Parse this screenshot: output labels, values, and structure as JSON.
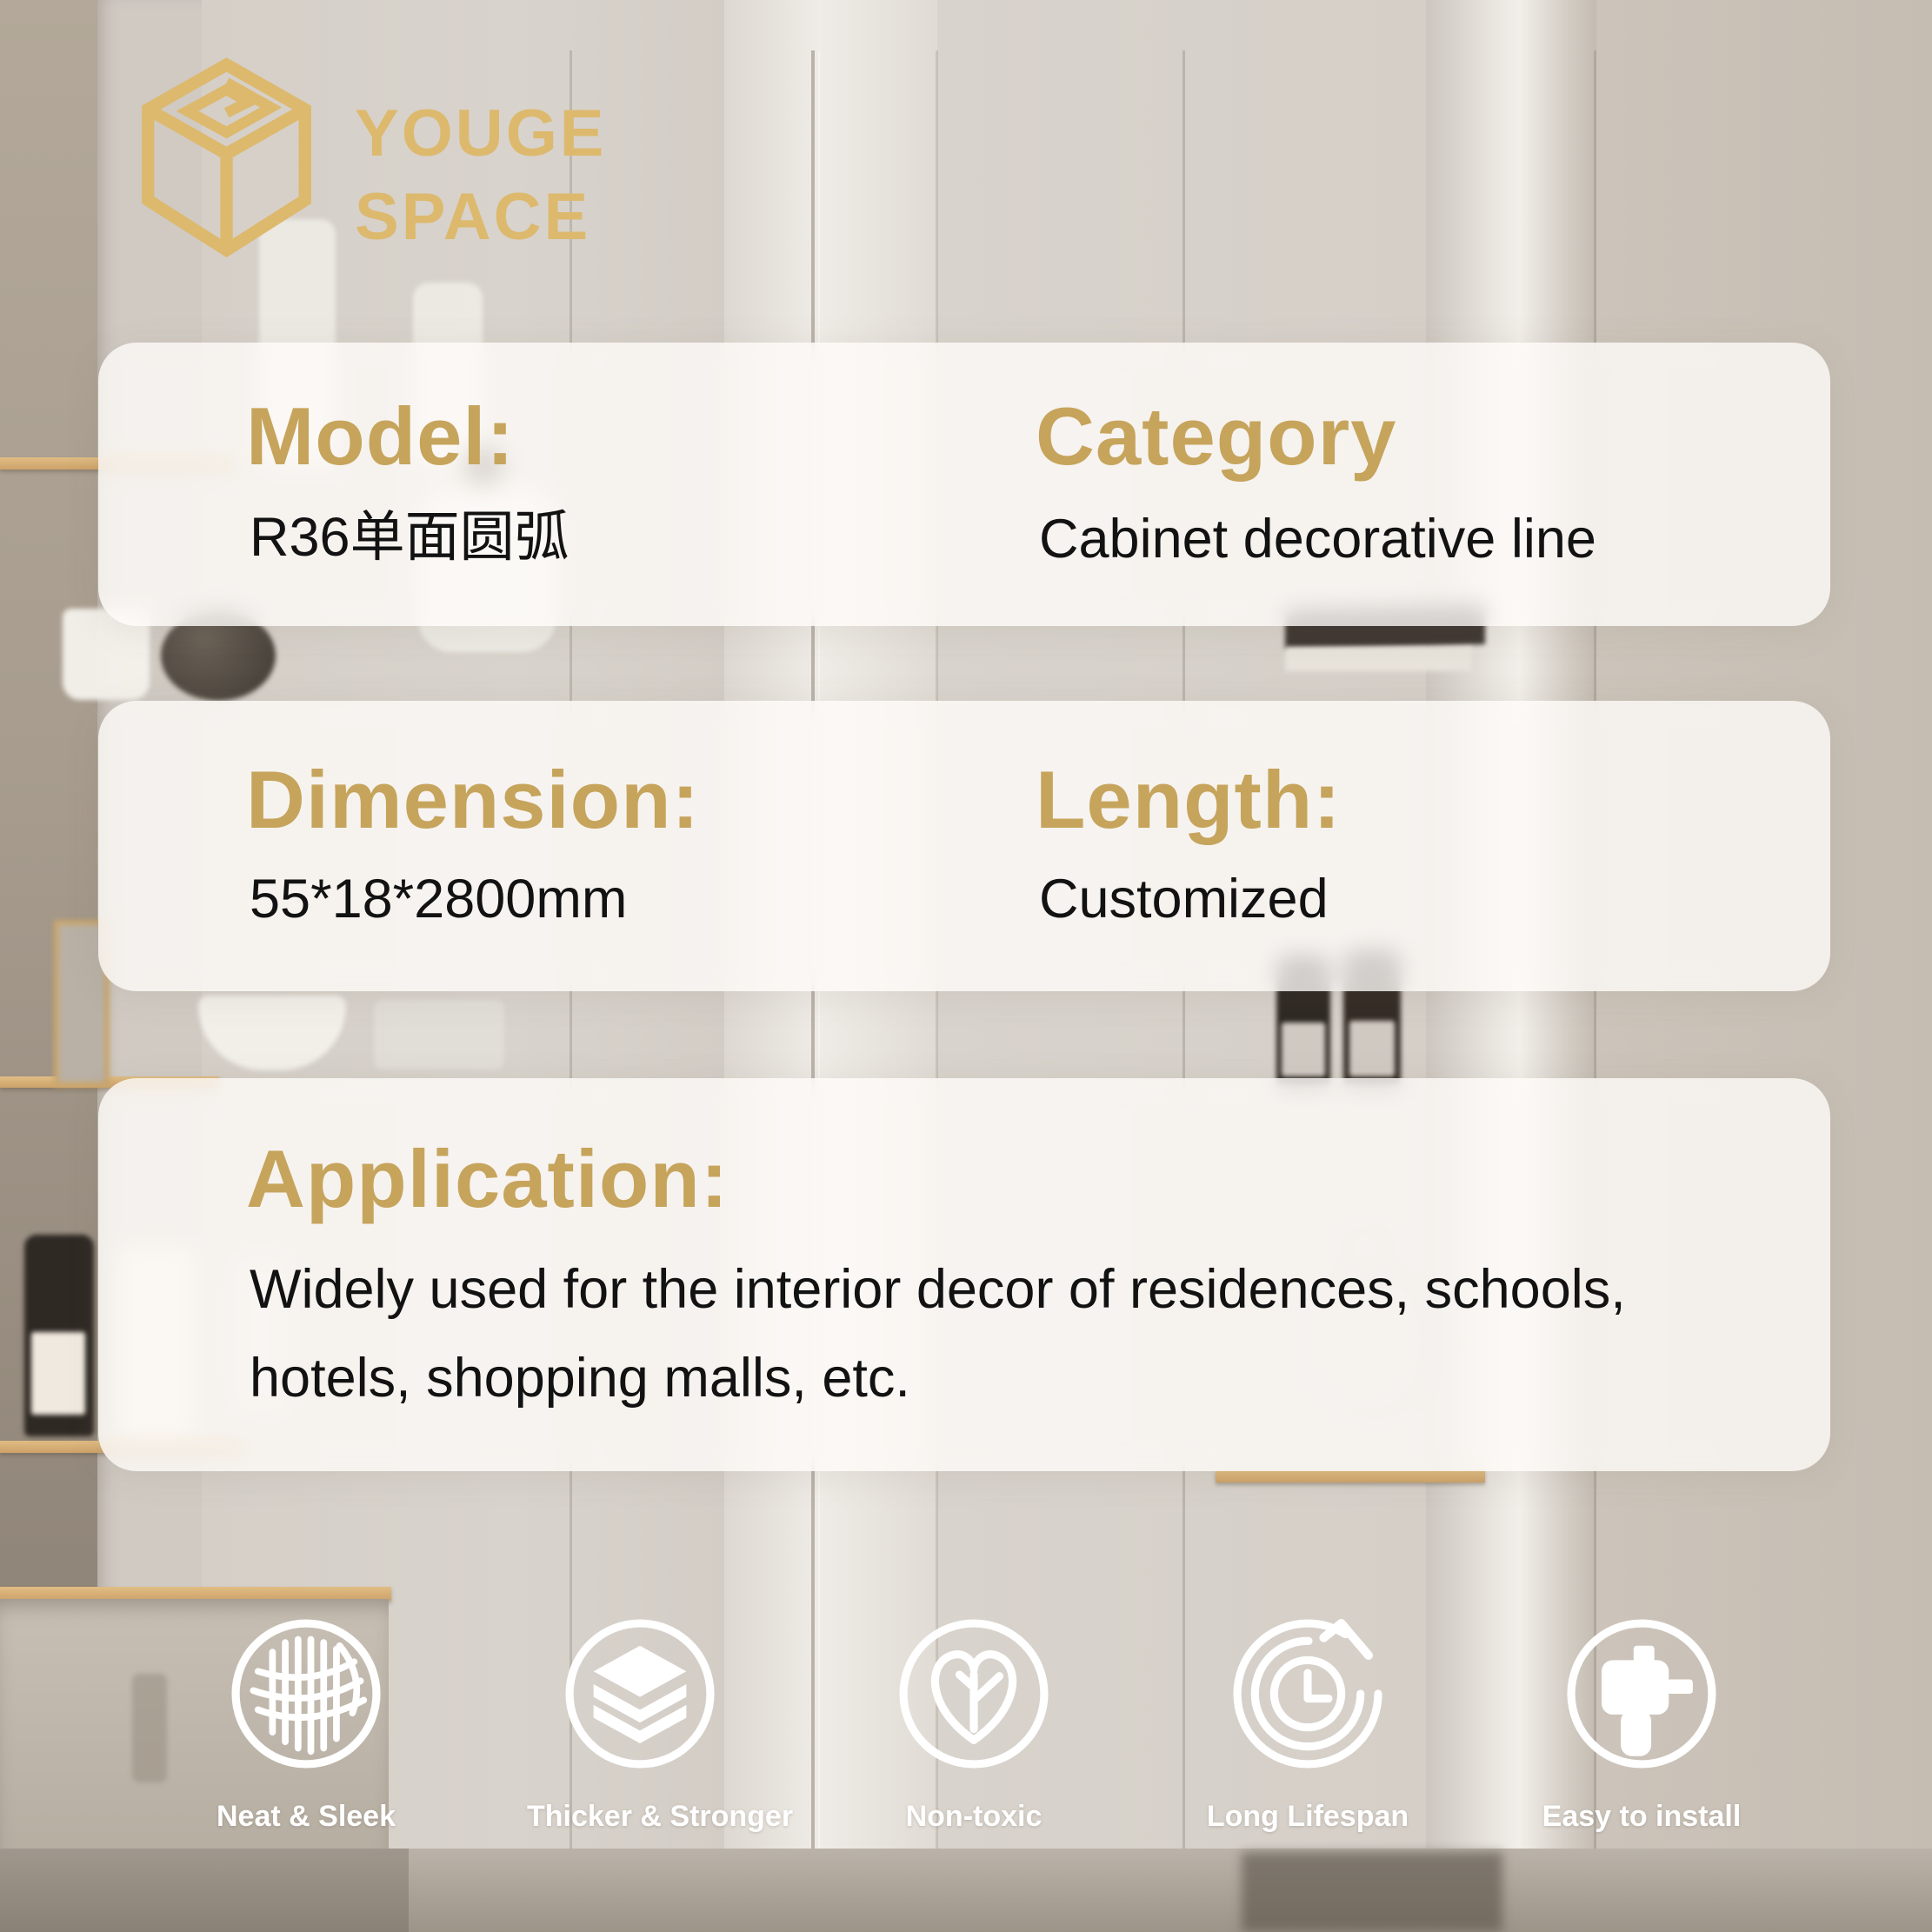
{
  "brand": {
    "line1": "YOUGE",
    "line2": "SPACE"
  },
  "colors": {
    "logo_gold": "#ddb96e",
    "heading_gold": "#c6a45c",
    "text_dark": "#121212",
    "card_background": "rgba(255,253,250,0.78)",
    "icon_white": "#ffffff"
  },
  "specs": {
    "model": {
      "label": "Model:",
      "value": "R36单面圆弧"
    },
    "category": {
      "label": "Category",
      "value": "Cabinet decorative line"
    },
    "dimension": {
      "label": "Dimension:",
      "value": "55*18*2800mm"
    },
    "length": {
      "label": "Length:",
      "value": "Customized"
    },
    "application": {
      "label": "Application:",
      "line1": "Widely used for the interior decor of residences, schools,",
      "line2": "hotels, shopping malls, etc."
    }
  },
  "features": [
    {
      "icon": "mesh-grid-icon",
      "label": "Neat & Sleek"
    },
    {
      "icon": "stacked-layers-icon",
      "label": "Thicker & Stronger"
    },
    {
      "icon": "heart-leaf-icon",
      "label": "Non-toxic"
    },
    {
      "icon": "clock-lifespan-icon",
      "label": "Long Lifespan"
    },
    {
      "icon": "drill-install-icon",
      "label": "Easy to install"
    }
  ]
}
